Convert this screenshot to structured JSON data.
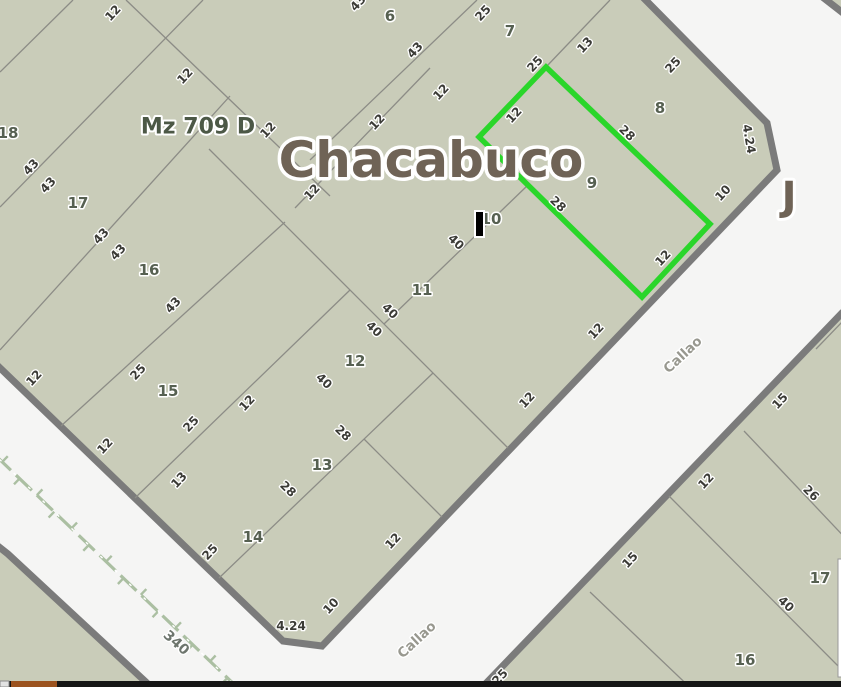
{
  "map": {
    "colors": {
      "street_bg": "#f5f5f4",
      "block_fill": "#c9ccb9",
      "block_border": "#7b7b7b",
      "lot_line": "#8c8c86",
      "highlight_green": "#2ad62a",
      "railway_green": "#abbfa2",
      "cursor_black": "#000000",
      "bar_black": "#161616",
      "bar_orange": "#9c531f",
      "bar_chip": "#e2e2e2"
    },
    "blocks": [
      {
        "id": "mz-709-d",
        "points": "-30,-30 616,-30 767,123 777,170 322,646 283,641 -30,339"
      },
      {
        "id": "block-southeast",
        "points": "842,313 900,313 900,700 470,700"
      },
      {
        "id": "block-southwest",
        "points": "-40,516 8,554 162,697 -40,697"
      },
      {
        "id": "block-northeast-sliver",
        "points": "816,-8 852,20 852,-8"
      }
    ],
    "lot_lines": [
      [
        73,
        0,
        0,
        72
      ],
      [
        126,
        0,
        330,
        196
      ],
      [
        203,
        0,
        0,
        207
      ],
      [
        230,
        96,
        0,
        350
      ],
      [
        285,
        222,
        61,
        426
      ],
      [
        350,
        290,
        135,
        498
      ],
      [
        433,
        373,
        219,
        578
      ],
      [
        209,
        149,
        508,
        448
      ],
      [
        477,
        0,
        310,
        160
      ],
      [
        610,
        0,
        546,
        67
      ],
      [
        430,
        68,
        295,
        208
      ],
      [
        528,
        185,
        384,
        324
      ],
      [
        364,
        439,
        442,
        517
      ],
      [
        816,
        349,
        843,
        321
      ],
      [
        744,
        431,
        852,
        545
      ],
      [
        669,
        496,
        852,
        680
      ],
      [
        590,
        592,
        700,
        697
      ]
    ],
    "highlight_parcel": {
      "parcel_id": "9",
      "points": "546,67 710,224 642,297 479,137"
    },
    "railway": {
      "x1": -5,
      "y1": 455,
      "x2": 240,
      "y2": 690,
      "label": "340",
      "label_x": 176,
      "label_y": 643,
      "label_rot": 42
    },
    "labels": {
      "block_title": {
        "text": "Mz 709 D",
        "x": 198,
        "y": 127
      },
      "street_main": {
        "text": "Chacabuco",
        "x": 431,
        "y": 160
      },
      "junction": {
        "text": "J",
        "x": 789,
        "y": 197
      },
      "streets": [
        {
          "text": "Callao",
          "x": 683,
          "y": 355,
          "rot": -43
        },
        {
          "text": "Callao",
          "x": 417,
          "y": 640,
          "rot": -43
        }
      ],
      "parcels": [
        {
          "text": "6",
          "x": 390,
          "y": 16
        },
        {
          "text": "7",
          "x": 510,
          "y": 31
        },
        {
          "text": "8",
          "x": 660,
          "y": 108
        },
        {
          "text": "9",
          "x": 592,
          "y": 183
        },
        {
          "text": "10",
          "x": 491,
          "y": 219
        },
        {
          "text": "11",
          "x": 422,
          "y": 290
        },
        {
          "text": "12",
          "x": 355,
          "y": 361
        },
        {
          "text": "13",
          "x": 322,
          "y": 465
        },
        {
          "text": "14",
          "x": 253,
          "y": 537
        },
        {
          "text": "15",
          "x": 168,
          "y": 391
        },
        {
          "text": "16",
          "x": 149,
          "y": 270
        },
        {
          "text": "17",
          "x": 78,
          "y": 203
        },
        {
          "text": "18",
          "x": 8,
          "y": 133
        },
        {
          "text": "17",
          "x": 820,
          "y": 578
        },
        {
          "text": "16",
          "x": 745,
          "y": 660
        }
      ],
      "dimensions": [
        {
          "text": "12",
          "x": 113,
          "y": 13,
          "rot": -47
        },
        {
          "text": "12",
          "x": 185,
          "y": 76,
          "rot": -47
        },
        {
          "text": "43",
          "x": 358,
          "y": 3,
          "rot": -47
        },
        {
          "text": "25",
          "x": 483,
          "y": 13,
          "rot": -47
        },
        {
          "text": "43",
          "x": 415,
          "y": 50,
          "rot": -47
        },
        {
          "text": "25",
          "x": 535,
          "y": 64,
          "rot": -47
        },
        {
          "text": "12",
          "x": 441,
          "y": 92,
          "rot": -47
        },
        {
          "text": "13",
          "x": 585,
          "y": 45,
          "rot": -47
        },
        {
          "text": "25",
          "x": 673,
          "y": 65,
          "rot": -47
        },
        {
          "text": "12",
          "x": 268,
          "y": 130,
          "rot": -47
        },
        {
          "text": "12",
          "x": 377,
          "y": 122,
          "rot": -47
        },
        {
          "text": "12",
          "x": 514,
          "y": 115,
          "rot": -47
        },
        {
          "text": "28",
          "x": 627,
          "y": 133,
          "rot": 44
        },
        {
          "text": "4.24",
          "x": 749,
          "y": 139,
          "rot": 80
        },
        {
          "text": "12",
          "x": 312,
          "y": 192,
          "rot": -47
        },
        {
          "text": "28",
          "x": 558,
          "y": 204,
          "rot": 44
        },
        {
          "text": "10",
          "x": 723,
          "y": 193,
          "rot": -47
        },
        {
          "text": "40",
          "x": 456,
          "y": 242,
          "rot": 44
        },
        {
          "text": "12",
          "x": 663,
          "y": 258,
          "rot": -47
        },
        {
          "text": "43",
          "x": 31,
          "y": 167,
          "rot": -47
        },
        {
          "text": "43",
          "x": 48,
          "y": 185,
          "rot": -47
        },
        {
          "text": "43",
          "x": 101,
          "y": 236,
          "rot": -47
        },
        {
          "text": "43",
          "x": 118,
          "y": 252,
          "rot": -47
        },
        {
          "text": "43",
          "x": 173,
          "y": 305,
          "rot": -47
        },
        {
          "text": "40",
          "x": 390,
          "y": 311,
          "rot": 44
        },
        {
          "text": "40",
          "x": 374,
          "y": 329,
          "rot": 44
        },
        {
          "text": "12",
          "x": 596,
          "y": 331,
          "rot": -47
        },
        {
          "text": "40",
          "x": 324,
          "y": 381,
          "rot": 44
        },
        {
          "text": "28",
          "x": 343,
          "y": 433,
          "rot": 44
        },
        {
          "text": "12",
          "x": 527,
          "y": 400,
          "rot": -47
        },
        {
          "text": "12",
          "x": 34,
          "y": 378,
          "rot": -47
        },
        {
          "text": "25",
          "x": 138,
          "y": 372,
          "rot": -47
        },
        {
          "text": "12",
          "x": 247,
          "y": 403,
          "rot": -47
        },
        {
          "text": "25",
          "x": 191,
          "y": 424,
          "rot": -47
        },
        {
          "text": "13",
          "x": 179,
          "y": 480,
          "rot": -47
        },
        {
          "text": "28",
          "x": 288,
          "y": 489,
          "rot": 44
        },
        {
          "text": "12",
          "x": 105,
          "y": 446,
          "rot": -47
        },
        {
          "text": "25",
          "x": 210,
          "y": 552,
          "rot": -47
        },
        {
          "text": "12",
          "x": 393,
          "y": 541,
          "rot": -47
        },
        {
          "text": "10",
          "x": 331,
          "y": 606,
          "rot": -47
        },
        {
          "text": "4.24",
          "x": 291,
          "y": 626,
          "rot": 0
        },
        {
          "text": "25",
          "x": 500,
          "y": 677,
          "rot": -47
        },
        {
          "text": "15",
          "x": 780,
          "y": 401,
          "rot": -47
        },
        {
          "text": "12",
          "x": 706,
          "y": 481,
          "rot": -47
        },
        {
          "text": "26",
          "x": 811,
          "y": 493,
          "rot": 44
        },
        {
          "text": "15",
          "x": 630,
          "y": 560,
          "rot": -47
        },
        {
          "text": "40",
          "x": 786,
          "y": 604,
          "rot": 44
        }
      ]
    },
    "cursor": {
      "x": 475,
      "y": 211,
      "w": 9,
      "h": 26
    },
    "side_panel": {
      "x": 838,
      "y": 559,
      "w": 4,
      "h": 118
    },
    "bottom_bar": {
      "y": 681,
      "h": 6,
      "chip": {
        "x": 0,
        "w": 9
      },
      "orange": {
        "x": 11,
        "w": 46
      }
    }
  }
}
